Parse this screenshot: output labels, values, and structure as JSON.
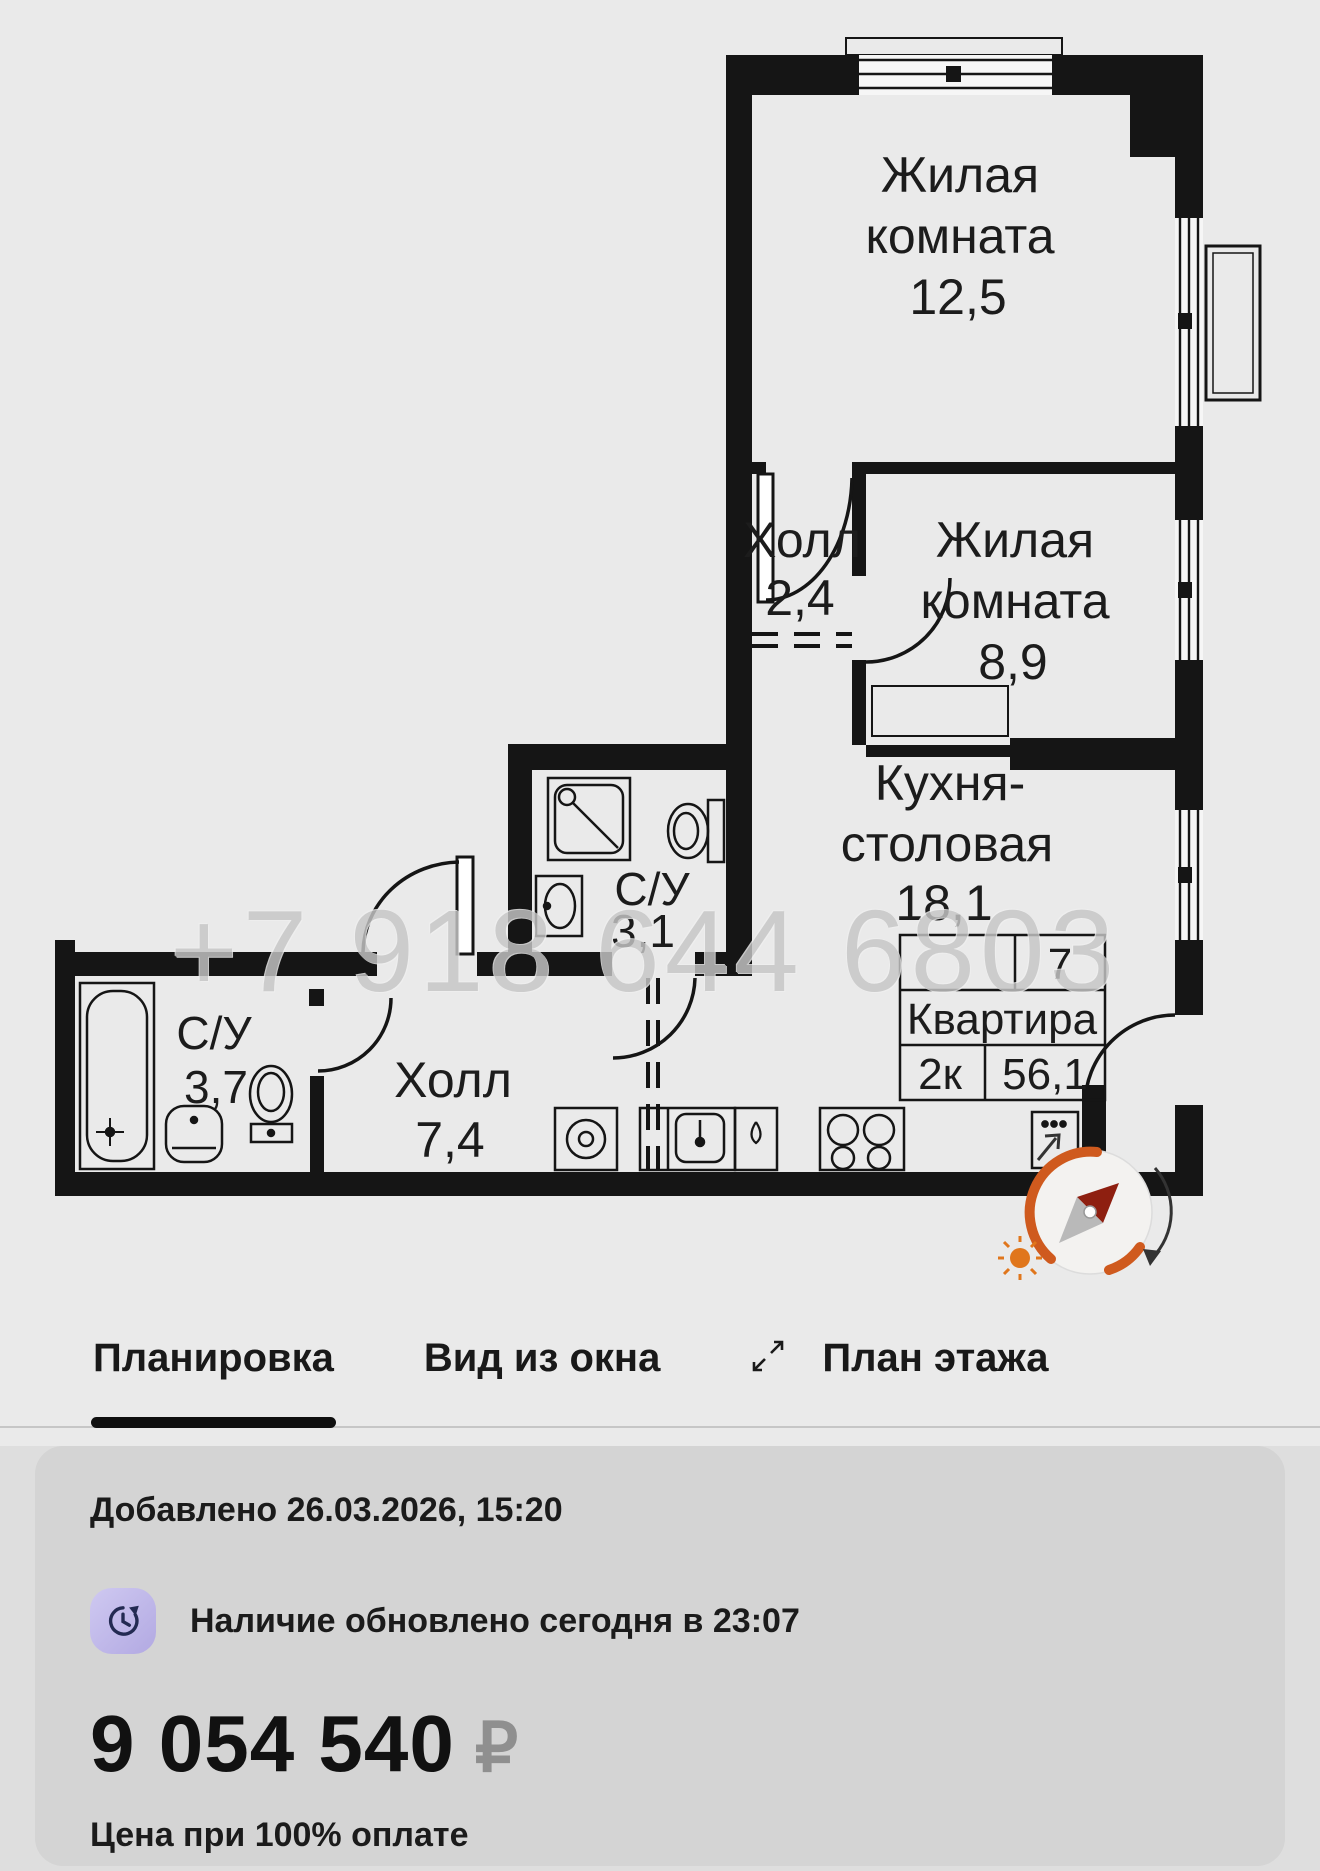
{
  "plan": {
    "watermark": "+7 918 644 6803",
    "rooms": {
      "living1": {
        "line1": "Жилая",
        "line2": "комната",
        "area": "12,5"
      },
      "living2": {
        "line1": "Жилая",
        "line2": "комната",
        "area": "8,9"
      },
      "hall_small": {
        "name": "Холл",
        "area": "2,4"
      },
      "kitchen": {
        "line1": "Кухня-",
        "line2": "столовая",
        "area": "18,1"
      },
      "wc_small": {
        "name": "С/У",
        "area": "3,1"
      },
      "wc_big": {
        "name": "С/У",
        "area": "3,7"
      },
      "hall_big": {
        "name": "Холл",
        "area": "7,4"
      }
    },
    "stamp": {
      "floor": "7",
      "label": "Квартира",
      "rooms": "2к",
      "area": "56,1"
    }
  },
  "tabs": [
    {
      "label": "Планировка",
      "active": true
    },
    {
      "label": "Вид из окна",
      "active": false
    },
    {
      "label": "План этажа",
      "active": false
    }
  ],
  "details": {
    "added": "Добавлено 26.03.2026, 15:20",
    "availability": "Наличие обновлено сегодня в 23:07"
  },
  "price": {
    "amount": "9 054 540",
    "currency": "₽",
    "note": "Цена при 100% оплате"
  },
  "colors": {
    "wall": "#151515",
    "plan_bg": "#eaeaea",
    "section_bg": "#dedede",
    "card_bg": "#d4d4d4",
    "accent_underline": "#0f0f0f",
    "watermark": "#c6c6c6",
    "compass_orange": "#cf5a1e",
    "compass_needle": "#8e1f10",
    "currency_gray": "#8f8f8f",
    "icon_gradient_start": "#cfc9f1",
    "icon_gradient_end": "#b2a9e2",
    "icon_glyph": "#232a52"
  }
}
